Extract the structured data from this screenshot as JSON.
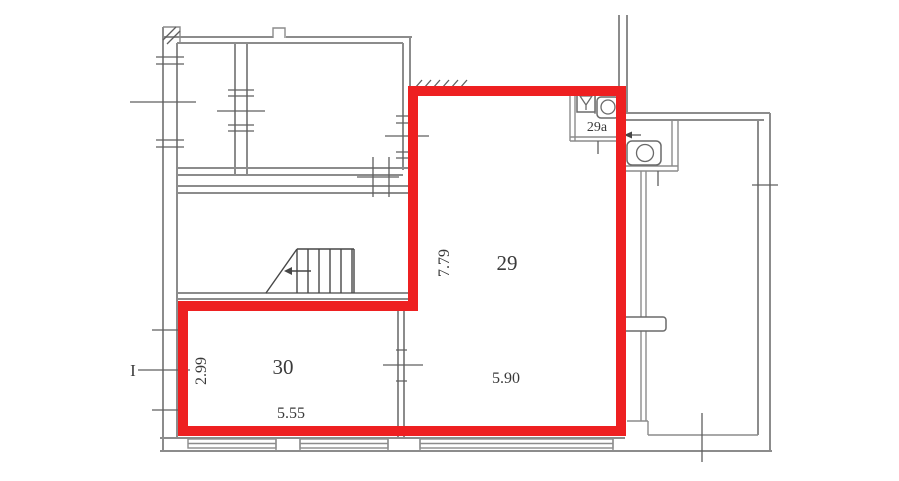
{
  "plan": {
    "axis_marker": "I",
    "rooms": [
      {
        "number": "29",
        "dim_vertical": "7.79",
        "dim_horizontal": "5.90"
      },
      {
        "number": "30",
        "dim_vertical": "2.99",
        "dim_horizontal": "5.55"
      },
      {
        "number": "29a"
      }
    ]
  },
  "icons": [
    "stairs-icon",
    "toilet-icon",
    "sink-icon",
    "shower-icon",
    "door-swing-icon",
    "radiator-icon"
  ],
  "colors": {
    "highlight": "#ee2021",
    "wall": "#8c8c8c",
    "detail": "#5f5f5f",
    "text": "#3a3a3a"
  }
}
